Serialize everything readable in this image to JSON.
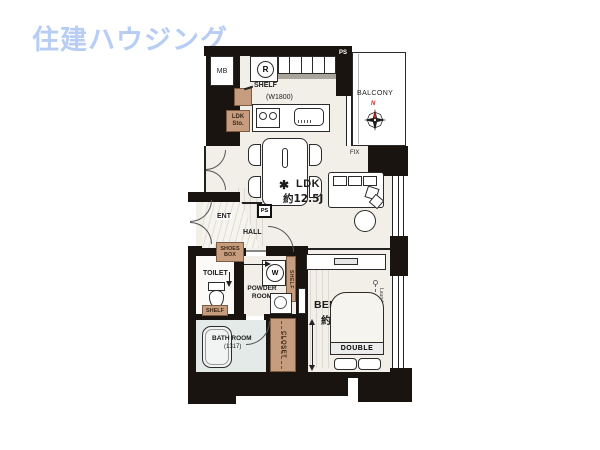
{
  "logo": {
    "text": "住建ハウジング"
  },
  "colors": {
    "logo_blue": "#b7cdf4",
    "wall_black": "#1a1410",
    "floor": "#f2efe9",
    "wood_brown": "#c79d7f",
    "bath_floor": "#e4eae8",
    "north_red": "#cc2222"
  },
  "plan": {
    "kitchen": {
      "mb": "MB",
      "refrigerator_mark": "R",
      "shelf": "SHELF",
      "counter_width": "(W1800)",
      "storage": "LDK Sto."
    },
    "balcony": {
      "ps": "PS",
      "label": "BALCONY",
      "north": "N",
      "fix_window": "FIX"
    },
    "ldk": {
      "name": "LDK",
      "size": "約12.5J",
      "plant_icon": "✱"
    },
    "entrance": {
      "ent": "ENT",
      "hall": "HALL",
      "ps": "PS",
      "shoes_box": "SHOES BOX"
    },
    "sanitary": {
      "toilet": "TOILET",
      "toilet_shelf": "SHELF",
      "powder_room": "POWDER ROOM",
      "washer_mark": "W",
      "powder_shelf": "SHELF",
      "bath_name": "BATH ROOM",
      "bath_size": "(1317)"
    },
    "bedroom": {
      "name": "BEDROOM",
      "size": "約4.6J",
      "bed": "DOUBLE",
      "laundry_pole": "Laundry pole",
      "closet": "CLOSET"
    }
  }
}
